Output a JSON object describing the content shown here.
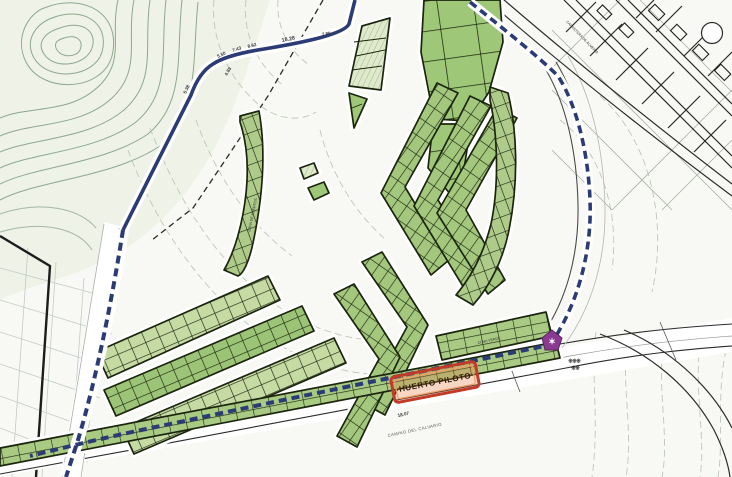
{
  "map": {
    "highlight_box": {
      "label": "HUERTO PILOTO"
    },
    "measurements": {
      "top": [
        "5.38",
        "5.50",
        "7.43",
        "8.62",
        "18.28",
        "7.80",
        "4.83"
      ],
      "road": "18.07"
    },
    "roads": {
      "bottom_name": "CAMINO DEL CALVARIO",
      "topright_name": "CARRETERA DE ALMERIA"
    },
    "areas": {
      "left_strip": "ZONA DE HUERTOS",
      "right_strip": "ZONA VERDE"
    },
    "icons": {
      "marker_glyph": "✶",
      "cluster_row1": "❋❋❋",
      "cluster_row2": "❋❋"
    },
    "colors": {
      "parcel_green": "#a3c77d",
      "parcel_light": "#c6dba4",
      "boundary_blue": "#2a3b76",
      "highlight_red": "#c23a28",
      "marker_purple": "#8a3a90",
      "contour_green": "#8ea88e"
    }
  }
}
